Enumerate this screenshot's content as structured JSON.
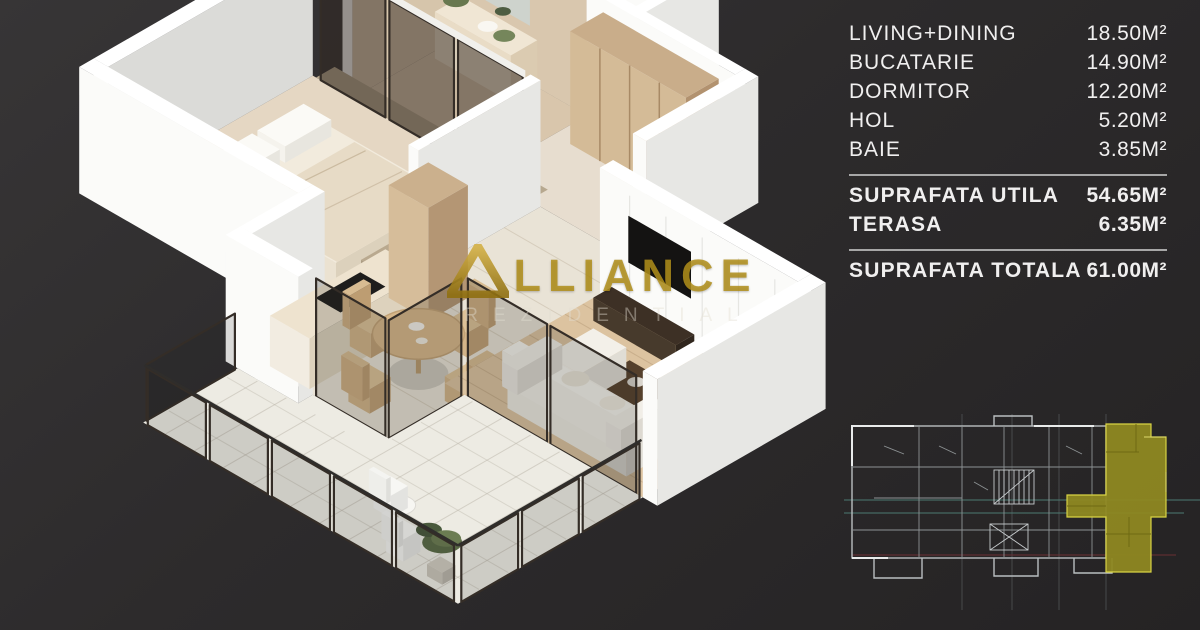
{
  "watermark": {
    "brand_mark": "triangle-icon",
    "brand_text": "LLIANCE",
    "subtitle": "REZIDENTIAL"
  },
  "area_table": {
    "rooms": [
      {
        "label": "LIVING+DINING",
        "value": "18.50M²"
      },
      {
        "label": "BUCATARIE",
        "value": "14.90M²"
      },
      {
        "label": "DORMITOR",
        "value": "12.20M²"
      },
      {
        "label": "HOL",
        "value": "5.20M²"
      },
      {
        "label": "BAIE",
        "value": "3.85M²"
      }
    ],
    "subtotals": [
      {
        "label": "SUPRAFATA UTILA",
        "value": "54.65M²"
      },
      {
        "label": "TERASA",
        "value": "6.35M²"
      }
    ],
    "total": {
      "label": "SUPRAFATA TOTALA",
      "value": "61.00M²"
    }
  },
  "floor_plan": {
    "type": "3d-isometric-apartment-render",
    "rooms_shown": [
      "dormitor",
      "baie",
      "hol",
      "bucatarie",
      "living+dining",
      "terasa"
    ]
  },
  "site_plan": {
    "description": "building key plan with highlighted unit",
    "highlight_color": "#8e8821"
  },
  "colors": {
    "background": "#2d2b2c",
    "text": "#f0efef",
    "divider": "#a7a7a7",
    "gold": "#b28f1b",
    "olive_highlight": "#8e8821",
    "floor_beige": "#e5d7c3",
    "wood_floor": "#dcc3a0"
  }
}
